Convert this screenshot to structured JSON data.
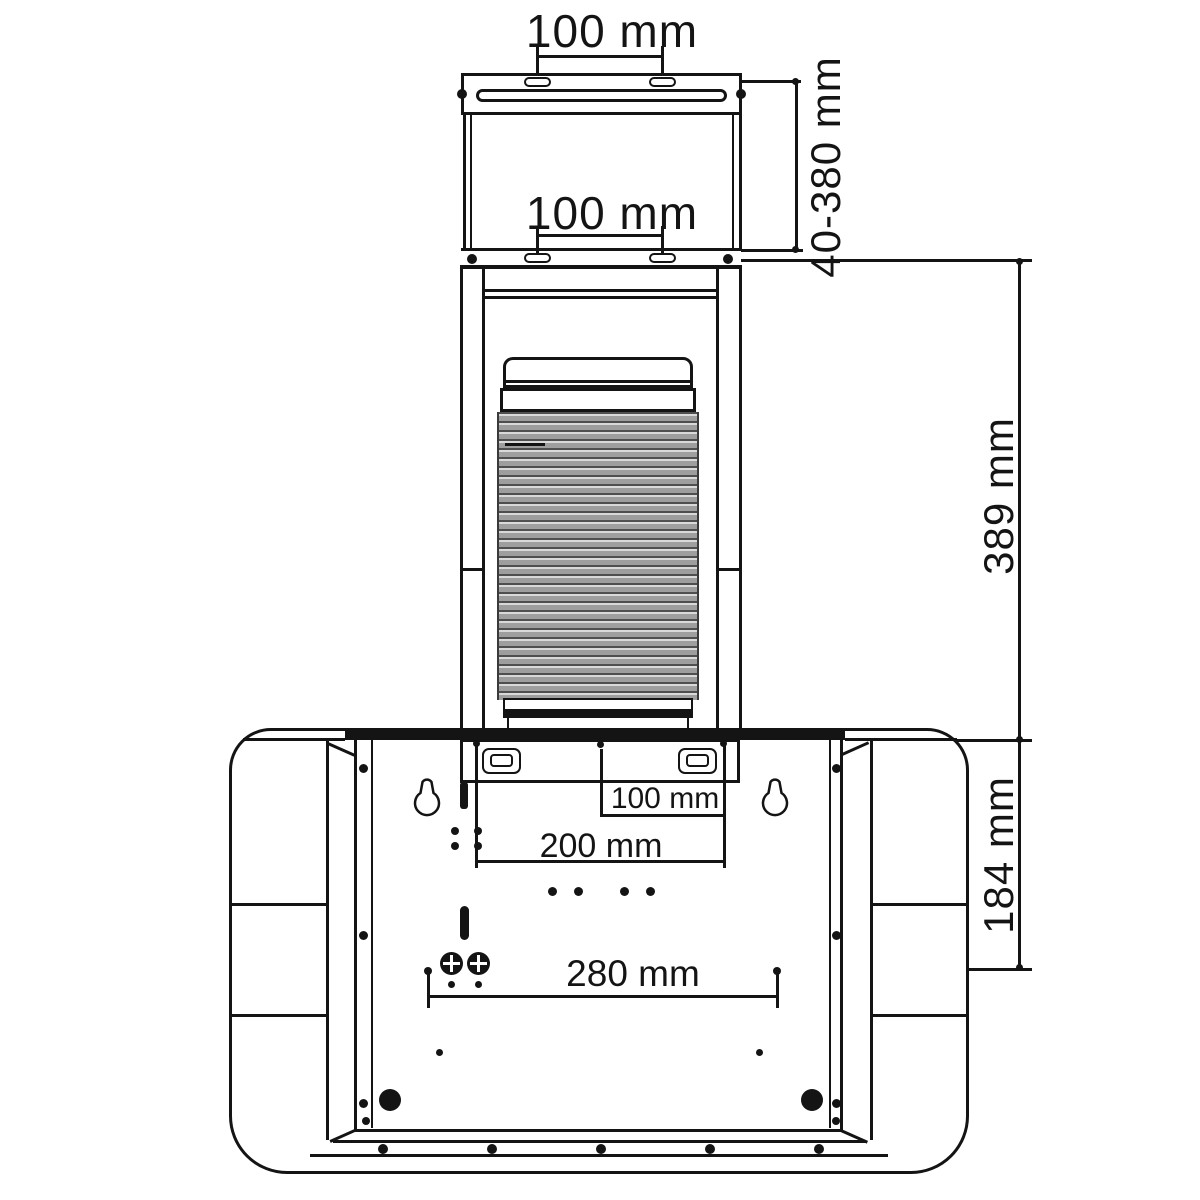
{
  "diagram": {
    "type": "technical-drawing",
    "subject": "Range hood telescopic chimney mounting dimensions, rear view",
    "dimensions": {
      "top_bracket_slot_spacing": "100 mm",
      "lower_bracket_slot_spacing": "100 mm",
      "telescopic_chimney_range": "40-380 mm",
      "lower_chimney_height": "389 mm",
      "body_top_to_mount_holes": "184 mm",
      "rear_offset_small": "100 mm",
      "rear_offset_large": "200 mm",
      "lower_mount_hole_spacing": "280 mm"
    },
    "colors": {
      "line": "#141414",
      "duct_fill": "#9e9e9e",
      "background": "#ffffff"
    }
  }
}
